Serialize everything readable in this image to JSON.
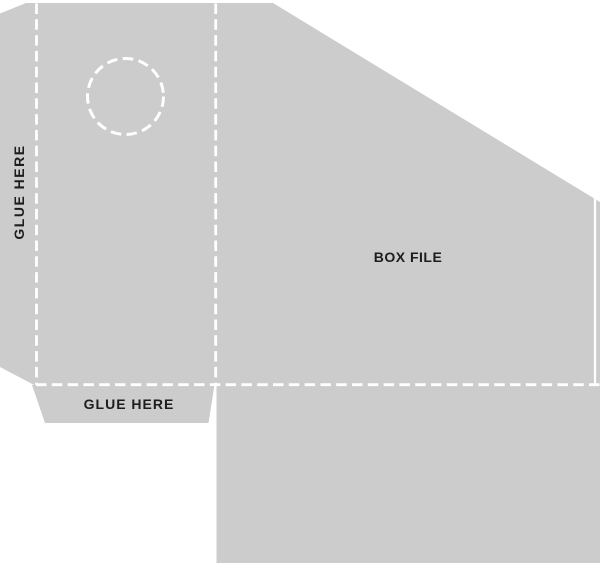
{
  "page": {
    "background": "#ffffff"
  },
  "template": {
    "panel_title": "BOX FILE",
    "glue_label_left": "GLUE HERE",
    "glue_label_bottom": "GLUE HERE",
    "colors": {
      "card_fill": "#cccccc",
      "fold_line": "#ffffff",
      "cut_line": "#ffffff",
      "label_text": "#1d1d1b"
    }
  }
}
